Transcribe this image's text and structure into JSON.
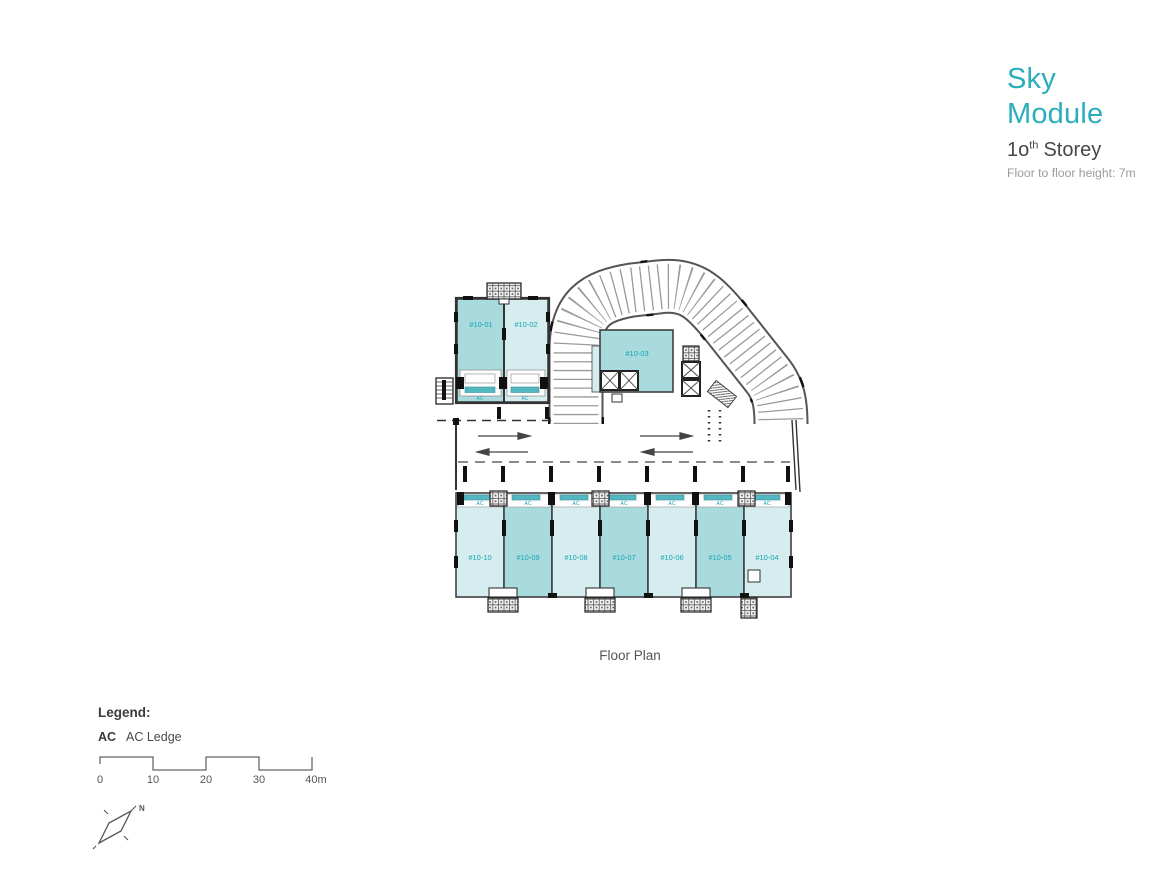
{
  "header": {
    "title_line1": "Sky",
    "title_line2": "Module",
    "storey_number": "1o",
    "storey_sup": "th",
    "storey_word": "Storey",
    "height_note": "Floor to floor height: 7m",
    "accent_color": "#2aafba"
  },
  "plan": {
    "caption": "Floor Plan",
    "ac_label": "AC",
    "units_top": [
      {
        "id": "#10-01",
        "shade": "dark"
      },
      {
        "id": "#10-02",
        "shade": "light"
      },
      {
        "id": "#10-03",
        "shade": "dark"
      }
    ],
    "units_bottom": [
      {
        "id": "#10-10",
        "shade": "light"
      },
      {
        "id": "#10-09",
        "shade": "dark"
      },
      {
        "id": "#10-08",
        "shade": "light"
      },
      {
        "id": "#10-07",
        "shade": "dark"
      },
      {
        "id": "#10-06",
        "shade": "light"
      },
      {
        "id": "#10-05",
        "shade": "dark"
      },
      {
        "id": "#10-04",
        "shade": "light"
      }
    ],
    "colors": {
      "unit_dark": "#a9dade",
      "unit_light": "#d6edf0",
      "unit_label": "#17a5b4",
      "ac_shutter": "#53b7c2"
    }
  },
  "legend": {
    "title": "Legend:",
    "items": [
      {
        "abbr": "AC",
        "label": "AC Ledge"
      }
    ]
  },
  "scale_bar": {
    "ticks": [
      "0",
      "10",
      "20",
      "30",
      "40m"
    ]
  },
  "compass": {
    "north_label": "N"
  }
}
